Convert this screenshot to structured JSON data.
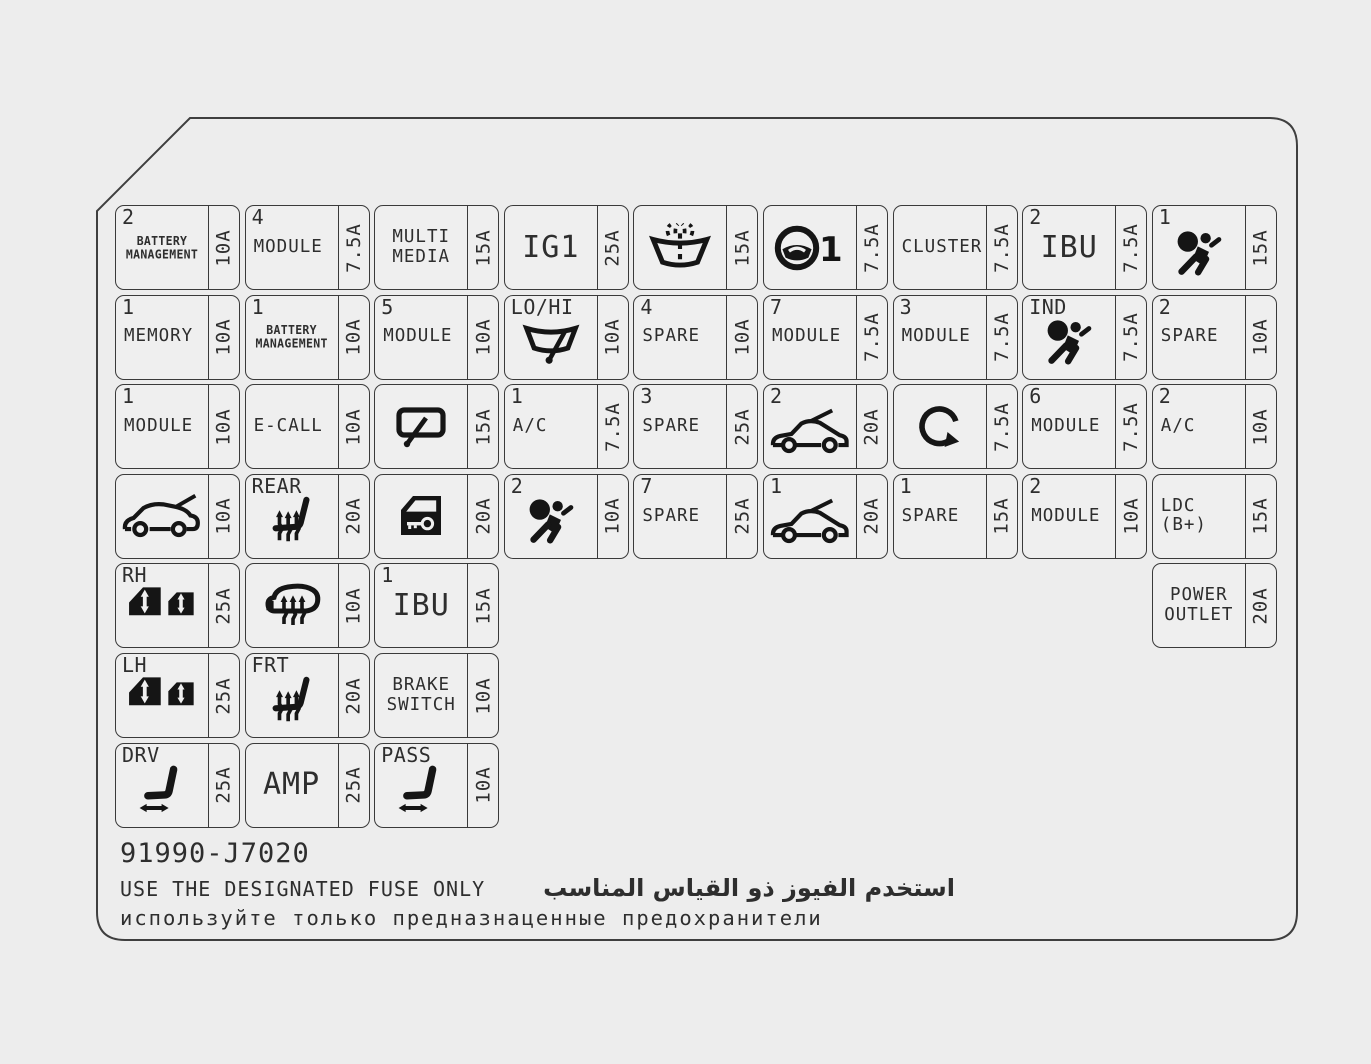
{
  "page": {
    "background": "#ededed",
    "line_color": "#3a3a3a",
    "text_color": "#2e2e2e",
    "icon_color": "#151515"
  },
  "part_number": "91990-J7020",
  "warnings": {
    "en": "USE THE DESIGNATED FUSE ONLY",
    "ar": "استخدم الفيوز ذو القياس المناسب",
    "ru": "используйте только предназнаценные предохранители"
  },
  "grid": {
    "rows": [
      {
        "cells": [
          {
            "col": 1,
            "corner": "2",
            "label": "BATTERY\nMANAGEMENT",
            "size": "xs",
            "amp": "10A"
          },
          {
            "col": 2,
            "corner": "4",
            "label": "MODULE",
            "size": "m",
            "amp": "7.5A"
          },
          {
            "col": 3,
            "label": "MULTI\nMEDIA",
            "size": "mc",
            "amp": "15A"
          },
          {
            "col": 4,
            "label": "IG1",
            "size": "l",
            "amp": "25A"
          },
          {
            "col": 5,
            "icon": "washer-windshield",
            "amp": "15A"
          },
          {
            "col": 6,
            "icon": "steering-wheel",
            "amp": "7.5A"
          },
          {
            "col": 7,
            "label": "CLUSTER",
            "size": "m",
            "amp": "7.5A"
          },
          {
            "col": 8,
            "corner": "2",
            "label": "IBU",
            "size": "l",
            "amp": "7.5A"
          },
          {
            "col": 9,
            "corner": "1",
            "icon": "airbag",
            "amp": "15A"
          }
        ]
      },
      {
        "cells": [
          {
            "col": 1,
            "corner": "1",
            "label": "MEMORY",
            "size": "m",
            "amp": "10A"
          },
          {
            "col": 2,
            "corner": "1",
            "label": "BATTERY\nMANAGEMENT",
            "size": "xs",
            "amp": "10A"
          },
          {
            "col": 3,
            "corner": "5",
            "label": "MODULE",
            "size": "m",
            "amp": "10A"
          },
          {
            "col": 4,
            "corner": "LO/HI",
            "icon": "wiper-windshield",
            "amp": "10A"
          },
          {
            "col": 5,
            "corner": "4",
            "label": "SPARE",
            "size": "m",
            "amp": "10A"
          },
          {
            "col": 6,
            "corner": "7",
            "label": "MODULE",
            "size": "m",
            "amp": "7.5A"
          },
          {
            "col": 7,
            "corner": "3",
            "label": "MODULE",
            "size": "m",
            "amp": "7.5A"
          },
          {
            "col": 8,
            "corner": "IND",
            "icon": "airbag",
            "amp": "7.5A"
          },
          {
            "col": 9,
            "corner": "2",
            "label": "SPARE",
            "size": "m",
            "amp": "10A"
          }
        ]
      },
      {
        "cells": [
          {
            "col": 1,
            "corner": "1",
            "label": "MODULE",
            "size": "m",
            "amp": "10A"
          },
          {
            "col": 2,
            "label": "E-CALL",
            "size": "m",
            "amp": "10A"
          },
          {
            "col": 3,
            "icon": "rear-wiper",
            "amp": "15A"
          },
          {
            "col": 4,
            "corner": "1",
            "label": "A/C",
            "size": "m",
            "amp": "7.5A"
          },
          {
            "col": 5,
            "corner": "3",
            "label": "SPARE",
            "size": "m",
            "amp": "25A"
          },
          {
            "col": 6,
            "corner": "2",
            "icon": "car-hood",
            "amp": "20A"
          },
          {
            "col": 7,
            "icon": "circular-arrow",
            "amp": "7.5A"
          },
          {
            "col": 8,
            "corner": "6",
            "label": "MODULE",
            "size": "m",
            "amp": "7.5A"
          },
          {
            "col": 9,
            "corner": "2",
            "label": "A/C",
            "size": "m",
            "amp": "10A"
          }
        ]
      },
      {
        "cells": [
          {
            "col": 1,
            "icon": "car-tailgate",
            "amp": "10A"
          },
          {
            "col": 2,
            "corner": "REAR",
            "icon": "heated-seat",
            "amp": "20A"
          },
          {
            "col": 3,
            "icon": "door-key",
            "amp": "20A"
          },
          {
            "col": 4,
            "corner": "2",
            "icon": "airbag",
            "amp": "10A"
          },
          {
            "col": 5,
            "corner": "7",
            "label": "SPARE",
            "size": "m",
            "amp": "25A"
          },
          {
            "col": 6,
            "corner": "1",
            "icon": "car-hood",
            "amp": "20A"
          },
          {
            "col": 7,
            "corner": "1",
            "label": "SPARE",
            "size": "m",
            "amp": "15A"
          },
          {
            "col": 8,
            "corner": "2",
            "label": "MODULE",
            "size": "m",
            "amp": "10A"
          },
          {
            "col": 9,
            "label": "LDC (B+)",
            "size": "m",
            "amp": "15A"
          }
        ]
      },
      {
        "cells": [
          {
            "col": 1,
            "corner": "RH",
            "icon": "power-windows",
            "amp": "25A"
          },
          {
            "col": 2,
            "icon": "heated-mirror",
            "amp": "10A"
          },
          {
            "col": 3,
            "corner": "1",
            "label": "IBU",
            "size": "l",
            "amp": "15A"
          },
          {
            "col": 9,
            "label": "POWER\nOUTLET",
            "size": "mc",
            "amp": "20A"
          }
        ]
      },
      {
        "cells": [
          {
            "col": 1,
            "corner": "LH",
            "icon": "power-windows",
            "amp": "25A"
          },
          {
            "col": 2,
            "corner": "FRT",
            "icon": "heated-seat",
            "amp": "20A"
          },
          {
            "col": 3,
            "label": "BRAKE\nSWITCH",
            "size": "mc",
            "amp": "10A"
          }
        ]
      },
      {
        "cells": [
          {
            "col": 1,
            "corner": "DRV",
            "icon": "power-seat",
            "amp": "25A"
          },
          {
            "col": 2,
            "label": "AMP",
            "size": "l",
            "amp": "25A"
          },
          {
            "col": 3,
            "corner": "PASS",
            "icon": "power-seat",
            "amp": "10A"
          }
        ]
      }
    ]
  }
}
